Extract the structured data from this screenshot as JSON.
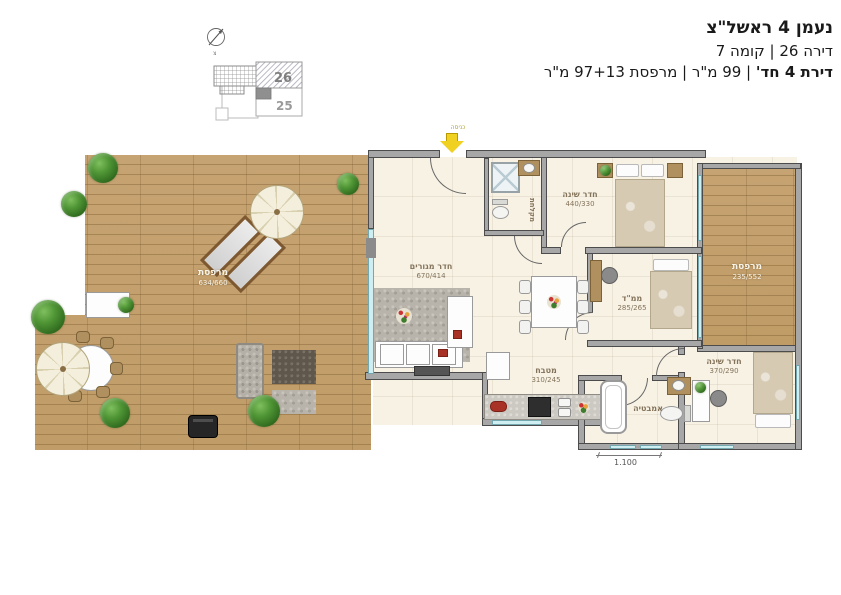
{
  "header": {
    "title": "נעמן 4 ראשל\"צ",
    "subtitle": "דירה 26 | קומה 7",
    "details_bold": "דירת 4 חד'",
    "details_rest": " | 99 מ\"ר | מרפסת 97+13 מ\"ר"
  },
  "keyplan": {
    "unit_26": "26",
    "unit_25": "25"
  },
  "compass": {
    "north": "צ"
  },
  "entrance": {
    "label": "כניסה"
  },
  "rooms": {
    "terrace": {
      "name": "מרפסת",
      "dims": "634/660"
    },
    "balcony": {
      "name": "מרפסת",
      "dims": "235/552"
    },
    "living": {
      "name": "חדר מגורים",
      "dims": "670/414"
    },
    "kitchen": {
      "name": "מטבח",
      "dims": "310/245"
    },
    "bedroom_master": {
      "name": "חדר שינה",
      "dims": "440/330"
    },
    "mamad": {
      "name": "ממ\"ד",
      "dims": "285/265"
    },
    "bedroom2": {
      "name": "חדר שינה",
      "dims": "370/290"
    },
    "bathroom": {
      "name": "אמבטיה"
    },
    "shower": {
      "name": "מקלחת"
    }
  },
  "dimension": {
    "label": "1.100"
  },
  "colors": {
    "deck_wood": "#c6a372",
    "wall": "#a7a7a7",
    "floor": "#f8f2e5",
    "window": "#cfeef2",
    "accent_red": "#a93226",
    "plant_green": "#3f7d2e",
    "entrance_arrow": "#f0d020"
  }
}
